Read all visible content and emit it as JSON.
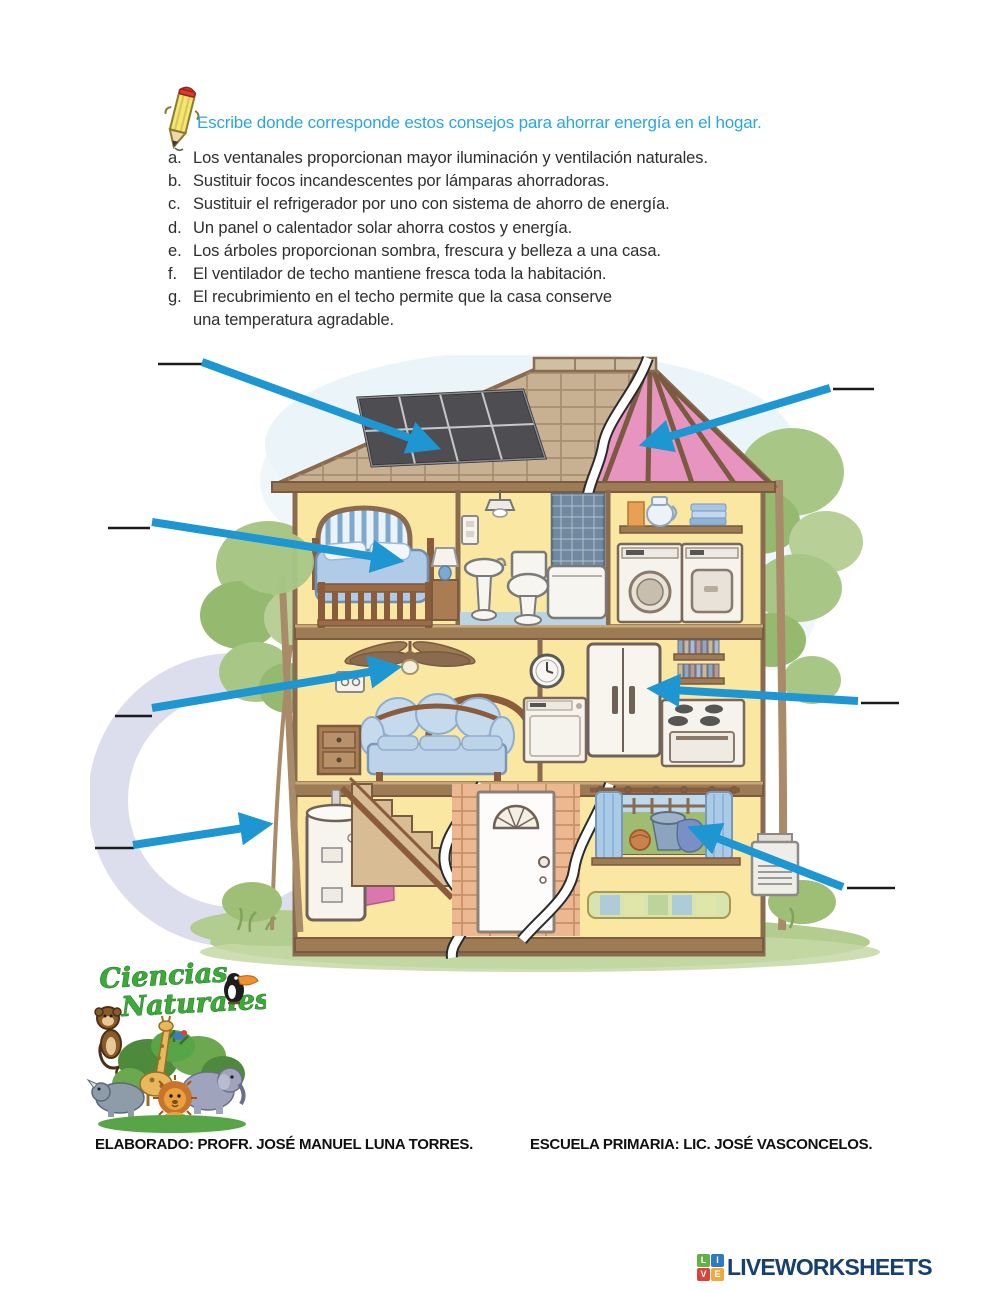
{
  "theme": {
    "arrow": "#1E96D2",
    "instruction": "#2AA7E0",
    "brand": "#17406E",
    "logo_green": "#3BAA36",
    "answer_line": "#1a1a1a"
  },
  "instruction": {
    "icon": "pencil-icon",
    "text": "Escribe donde corresponde estos consejos para ahorrar energía en el hogar."
  },
  "tips": [
    {
      "letter": "a.",
      "text": "Los ventanales proporcionan mayor iluminación y ventilación naturales."
    },
    {
      "letter": "b.",
      "text": "Sustituir focos incandescentes por lámparas ahorradoras."
    },
    {
      "letter": "c.",
      "text": "Sustituir el refrigerador por uno con sistema de ahorro de energía."
    },
    {
      "letter": "d.",
      "text": "Un panel o calentador solar ahorra costos y energía."
    },
    {
      "letter": "e.",
      "text": "Los árboles proporcionan sombra, frescura y belleza a una casa."
    },
    {
      "letter": "f.",
      "text": "El ventilador de techo mantiene fresca toda la habitación."
    },
    {
      "letter": "g.",
      "text": "El recubrimiento en el techo permite que la casa conserve",
      "text2": "una temperatura agradable."
    }
  ],
  "diagram": {
    "description": "Cutaway illustration of a two-story house with seven blue arrows pointing to: solar panel on roof, pink insulated roof covering, bedroom window, ceiling fan, refrigerator, trees beside the house, and a large ground-floor window; each arrow starts at a blank answer line.",
    "answer_blanks": 7,
    "arrow_targets": [
      "solar-panel",
      "roof-covering",
      "bedroom-window",
      "ceiling-fan",
      "refrigerator",
      "trees",
      "ground-floor-window"
    ]
  },
  "logo_ciencias": {
    "line1": "Ciencias",
    "line2": "Naturales"
  },
  "footer": {
    "left": "ELABORADO: PROFR. JOSÉ MANUEL LUNA TORRES.",
    "right": "ESCUELA PRIMARIA: LIC. JOSÉ VASCONCELOS."
  },
  "brand": {
    "name": "LIVEWORKSHEETS",
    "squares": [
      {
        "letter": "L",
        "color": "#62B146"
      },
      {
        "letter": "I",
        "color": "#2F79C2"
      },
      {
        "letter": "V",
        "color": "#D9433B"
      },
      {
        "letter": "E",
        "color": "#F0A93B"
      }
    ]
  }
}
